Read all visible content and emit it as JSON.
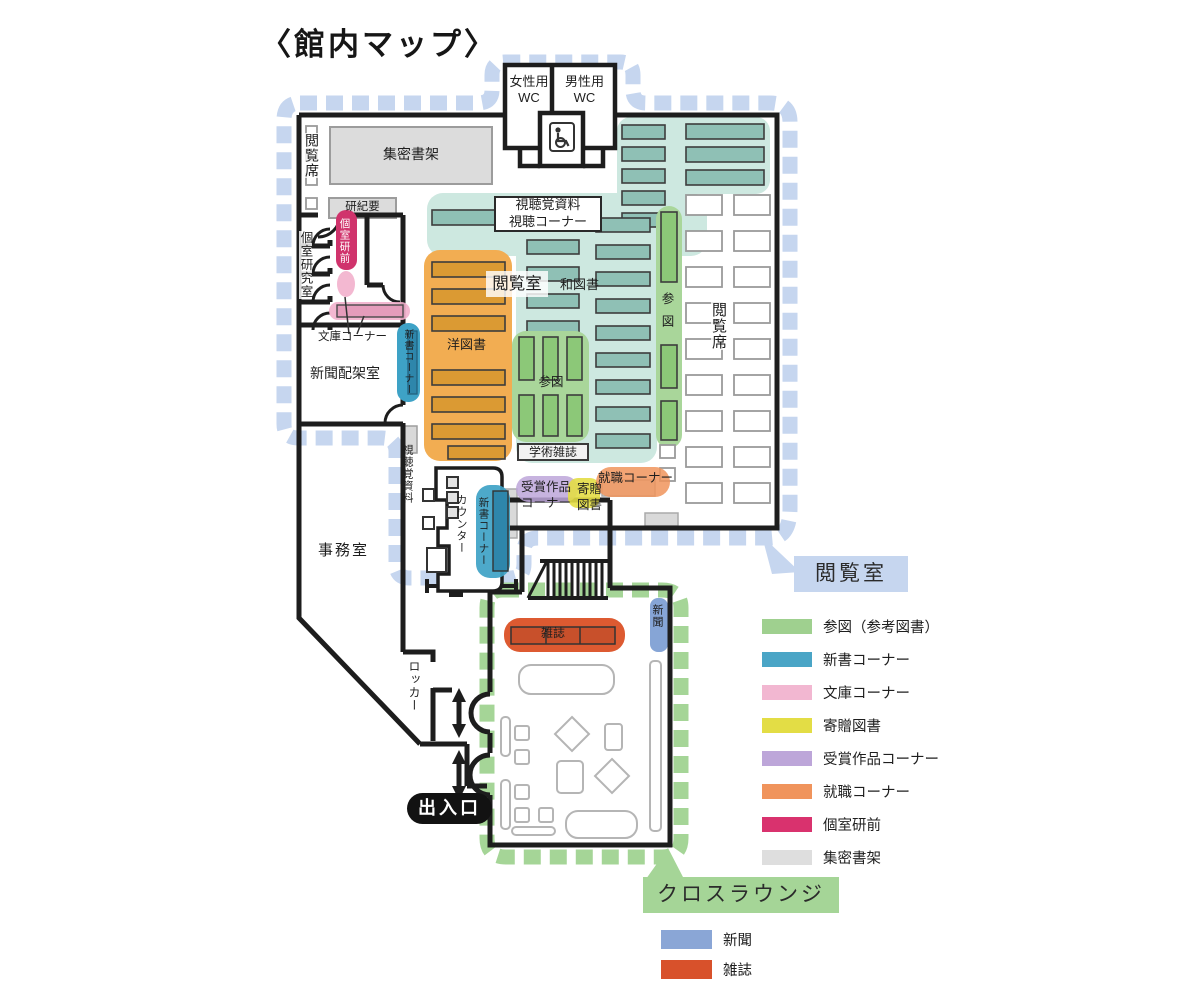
{
  "title": "〈館内マップ〉",
  "map": {
    "rooms": {
      "wc_female": "女性用\nWC",
      "wc_male": "男性用\nWC",
      "compact_stacks": "集密書架",
      "reading_seats_left": "閲覧席",
      "kenkiyo": "研紀要",
      "private_study_rooms": "個室研究室",
      "private_study_front": "個室研前",
      "bunko_corner": "文庫コーナー",
      "newspaper_rack_room": "新聞配架室",
      "shinsho_corner_upper": "新書コーナー",
      "av_corner": "視聴覚資料\n視聴コーナー",
      "reading_room": "閲覧室",
      "japanese_books": "和図書",
      "western_books": "洋図書",
      "reference_center": "参図",
      "reference_strip": "参図",
      "academic_journals": "学術雑誌",
      "reading_seats_right": "閲覧席",
      "career_corner": "就職コーナー",
      "award_works_corner": "受賞作品\nコーナー",
      "donated_books": "寄贈\n図書",
      "shinsho_corner_lower": "新書コーナー",
      "counter": "カウンター",
      "av_materials": "視聴覚資料",
      "office": "事務室",
      "locker": "ロッカー",
      "entrance": "出入口",
      "magazine_shelf": "雑誌",
      "newspaper_shelf": "新聞"
    }
  },
  "callouts": {
    "reading_room": "閲覧室",
    "cross_lounge": "クロスラウンジ"
  },
  "legend_reading_room": {
    "items": [
      {
        "label": "参図（参考図書）",
        "color": "#9fd08f"
      },
      {
        "label": "新書コーナー",
        "color": "#4aa5c6"
      },
      {
        "label": "文庫コーナー",
        "color": "#f2b7d1"
      },
      {
        "label": "寄贈図書",
        "color": "#e3dd45"
      },
      {
        "label": "受賞作品コーナー",
        "color": "#bda6d9"
      },
      {
        "label": "就職コーナー",
        "color": "#f0945c"
      },
      {
        "label": "個室研前",
        "color": "#d9326e"
      },
      {
        "label": "集密書架",
        "color": "#dedede"
      }
    ]
  },
  "legend_lounge": {
    "items": [
      {
        "label": "新聞",
        "color": "#8aa6d6"
      },
      {
        "label": "雑誌",
        "color": "#d8512b"
      }
    ]
  },
  "colors": {
    "walls": "#1d1d1d",
    "reading_route": "#c6d6ef",
    "lounge_route": "#a5d597",
    "teal_area": "#cde8e0",
    "teal_shelf": "#8fc0b5",
    "orange_area": "#f2ad52",
    "orange_shelf": "#db9a33"
  }
}
